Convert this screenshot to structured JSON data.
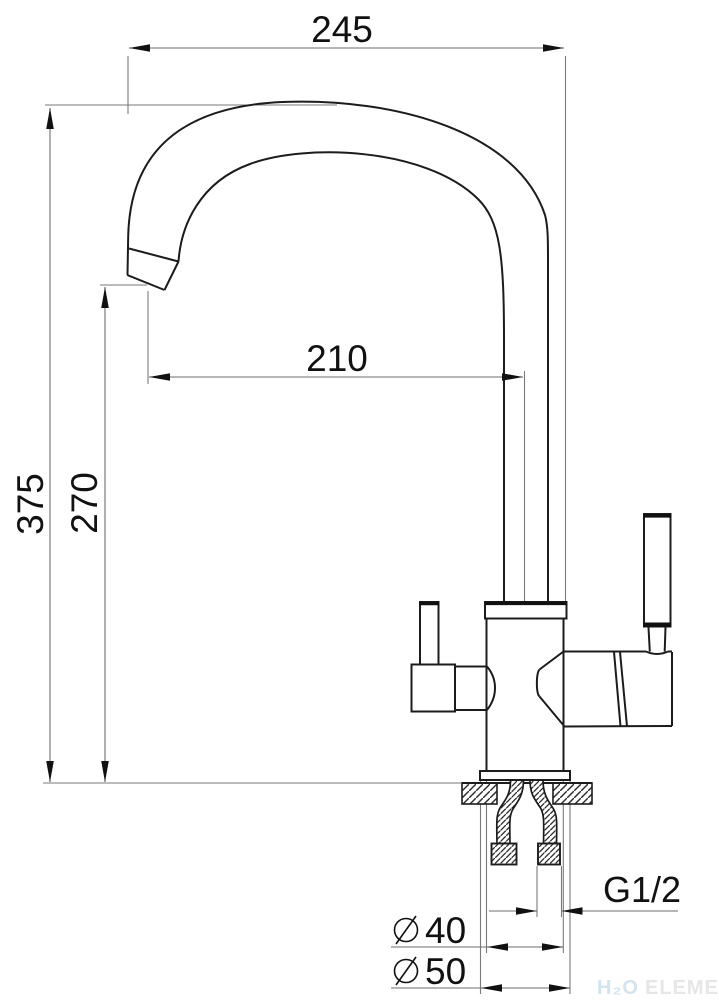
{
  "drawing": {
    "type": "kitchen-faucet-technical-drawing",
    "dimensions": {
      "overall_width": {
        "value": "245"
      },
      "overall_height": {
        "value": "375"
      },
      "spout_height": {
        "value": "270"
      },
      "spout_reach": {
        "value": "210"
      },
      "thread_size": {
        "value": "G1/2"
      },
      "body_diameter": {
        "value": "40"
      },
      "base_diameter": {
        "value": "50"
      }
    },
    "watermark": {
      "logo_h2o": "H₂O",
      "logo_element": "ELEMENT"
    },
    "colors": {
      "line": "#1c1c1c",
      "dimension": "#6e6e6e",
      "text": "#111111",
      "watermark_h2o": "#d2e4ee",
      "watermark_element": "#e6e6e6",
      "background": "#ffffff"
    }
  }
}
